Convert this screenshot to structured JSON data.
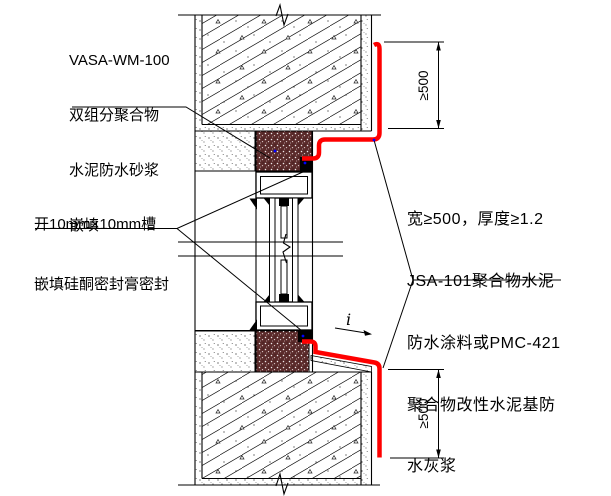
{
  "drawing": {
    "title_hint": "window joint waterproofing detail",
    "annotations": {
      "top_left": {
        "lines": [
          "VASA-WM-100",
          "双组分聚合物",
          "水泥防水砂浆",
          "嵌填"
        ]
      },
      "mid_left": {
        "lines": [
          "开10mm×10mm槽",
          "嵌填硅酮密封膏密封"
        ]
      },
      "right": {
        "lines": [
          "宽≥500，厚度≥1.2",
          "JSA-101聚合物水泥",
          "防水涂料或PMC-421",
          "聚合物改性水泥基防",
          "水灰浆"
        ]
      },
      "dimension_top": "≥500",
      "dimension_bottom": "≥500",
      "slope_label": "i"
    },
    "colors": {
      "membrane": "#ff0000",
      "waterproof_mortar": "#5b2b2b",
      "sealant": "#000000",
      "leader_dot": "#0000ff",
      "linework": "#000000",
      "background": "#ffffff"
    }
  }
}
